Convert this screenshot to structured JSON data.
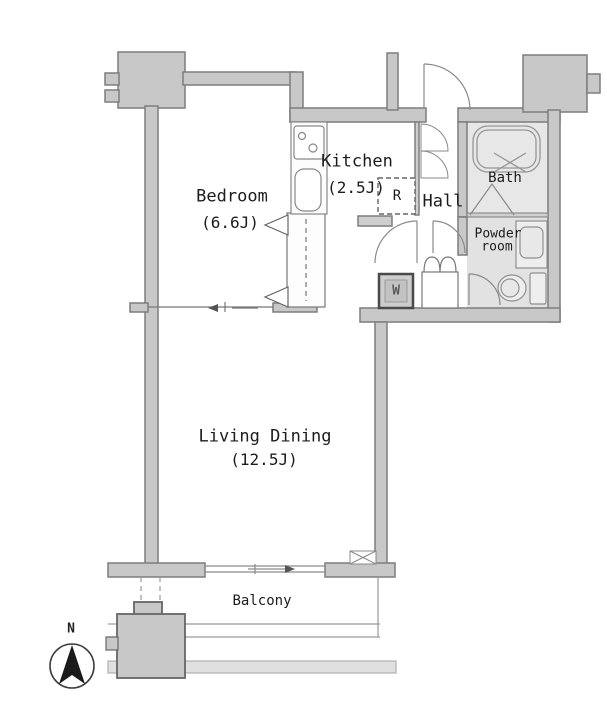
{
  "plan_title": "1LDK apartment floor plan",
  "rooms": {
    "bedroom": {
      "name": "Bedroom",
      "size": "(6.6J)"
    },
    "kitchen": {
      "name": "Kitchen",
      "size": "(2.5J)"
    },
    "living_dining": {
      "name": "Living Dining",
      "size": "(12.5J)"
    },
    "hall": {
      "name": "Hall"
    },
    "bath": {
      "name": "Bath"
    },
    "powder_room": {
      "name_line1": "Powder",
      "name_line2": "room"
    },
    "balcony": {
      "name": "Balcony"
    }
  },
  "appliances": {
    "refrigerator_label": "R",
    "washer_label": "W"
  },
  "compass": {
    "north_label": "N"
  },
  "colors": {
    "wall_fill": "#c8c8c8",
    "wall_stroke": "#7d7d7d",
    "thin_line": "#8a8a8a",
    "bath_floor": "#e7e7e7",
    "powder_floor": "#e2e2e2",
    "compass_arrow": "#1a1a1a"
  }
}
